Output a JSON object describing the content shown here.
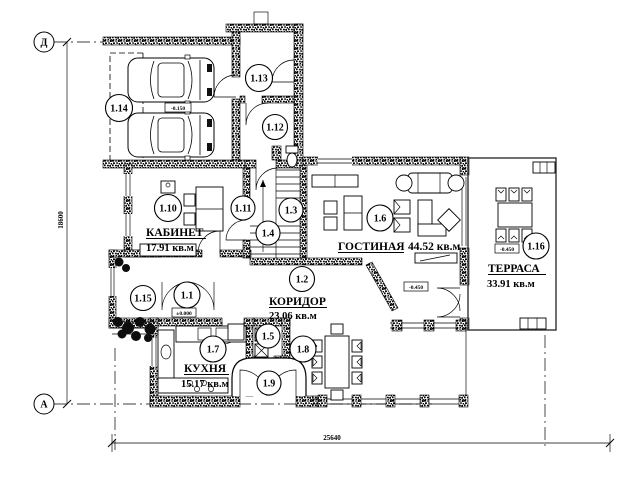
{
  "plan": {
    "axis_markers": {
      "top": "Д",
      "bottom": "А"
    },
    "dimensions": {
      "left_total": "18600",
      "bottom_total": "25640"
    },
    "rooms": {
      "kabinet": {
        "name": "КАБИНЕТ",
        "area": "17.91 кв.м"
      },
      "gostinaya": {
        "name": "ГОСТИНАЯ",
        "area": "44.52 кв.м"
      },
      "koridor": {
        "name": "КОРИДОР",
        "area": "23.06 кв.м"
      },
      "kuhnya": {
        "name": "КУХНЯ",
        "area": "15.17 кв.м"
      },
      "terrasa": {
        "name": "ТЕРРАСА",
        "area": "33.91 кв.м"
      }
    },
    "room_numbers": [
      "1.1",
      "1.2",
      "1.3",
      "1.4",
      "1.5",
      "1.6",
      "1.7",
      "1.8",
      "1.9",
      "1.10",
      "1.11",
      "1.12",
      "1.13",
      "1.14",
      "1.15",
      "1.16"
    ],
    "elevations": {
      "garage": "-0.150",
      "entry": "±0.000",
      "living": "-0.450",
      "terrace": "-0.450"
    }
  }
}
